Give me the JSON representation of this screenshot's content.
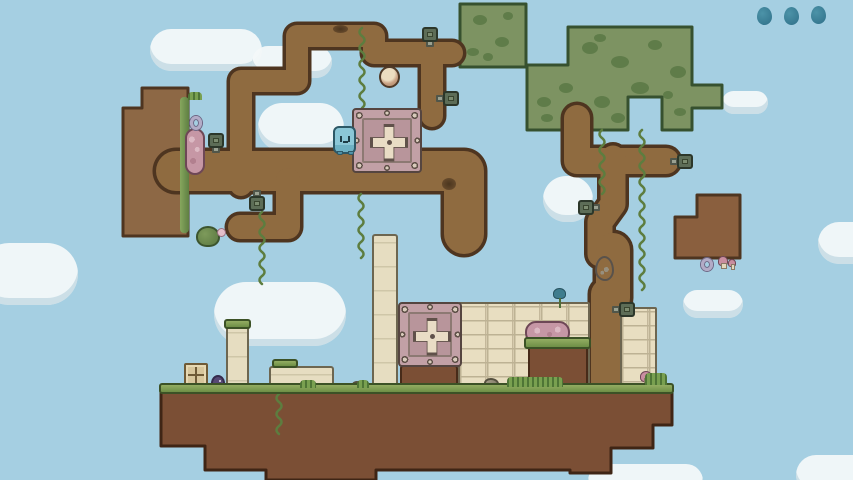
{
  "hud": {
    "menu_dots": {
      "count": 3,
      "color": "#3a7d93",
      "w": 15,
      "h": 18,
      "items": [
        {
          "x": 757,
          "y": 7
        },
        {
          "x": 784,
          "y": 7
        },
        {
          "x": 811,
          "y": 6
        }
      ]
    }
  },
  "palette": {
    "sky": "#a5cfe2",
    "path_fill": "#8f6b40",
    "path_outline": "#4e3520",
    "island_fill": "#7b4f35",
    "island_outline": "#3f2515",
    "hedge_fill": "#7d9362",
    "hedge_spot": "#5f7c49",
    "hedge_outline": "#36512f",
    "block_left_fill": "#8d6845",
    "block_right_fill": "#8a5f3e",
    "vine": "#5d7d3f",
    "stone": "#e8dec1",
    "crate_pink": "#c2a0a6",
    "character_blue": "#8bc7d7",
    "dot_teal": "#3a7d93"
  },
  "terrain": {
    "hedges": [
      {
        "name": "hedge-block-small",
        "d": "M460 4 H526 V67 H460 Z"
      },
      {
        "name": "hedge-block-large",
        "d": "M568 27 H692 V85 H722 V108 H692 V130 H662 V97 H628 V130 H527 V65 H568 Z"
      }
    ],
    "hedge_spots": [
      [
        480,
        20,
        7,
        5
      ],
      [
        502,
        42,
        7,
        5
      ],
      [
        473,
        52,
        6,
        4
      ],
      [
        508,
        16,
        5,
        4
      ],
      [
        488,
        57,
        5,
        4
      ],
      [
        590,
        48,
        8,
        6
      ],
      [
        620,
        62,
        9,
        6
      ],
      [
        655,
        45,
        7,
        5
      ],
      [
        678,
        72,
        8,
        6
      ],
      [
        640,
        88,
        9,
        6
      ],
      [
        602,
        102,
        8,
        6
      ],
      [
        566,
        88,
        7,
        5
      ],
      [
        544,
        102,
        7,
        5
      ],
      [
        680,
        112,
        6,
        4
      ],
      [
        618,
        118,
        7,
        5
      ],
      [
        584,
        120,
        6,
        4
      ],
      [
        547,
        118,
        6,
        4
      ],
      [
        600,
        38,
        6,
        4
      ],
      [
        668,
        95,
        5,
        4
      ]
    ],
    "blocks": [
      {
        "name": "dirt-block-left",
        "fill": "#8d6845",
        "d": "M142 88 H188 V236 H123 V108 H142 Z"
      },
      {
        "name": "dirt-block-right",
        "fill": "#8a5f3e",
        "d": "M697 195 H740 V258 H675 V217 H697 Z"
      }
    ],
    "routes": [
      {
        "name": "dirt-path-main",
        "d": "M 176 171 H 464 V 234",
        "w": 40
      },
      {
        "name": "dirt-path-hook",
        "d": "M 288 180 V 227 H 240",
        "w": 24
      },
      {
        "name": "dirt-path-stairs",
        "d": "M 241 185 V 81 H 297 V 36 H 374 V 53 H 452",
        "w": 22
      },
      {
        "name": "dirt-path-drop",
        "d": "M 432 60 V 116",
        "w": 22
      },
      {
        "name": "dirt-trunk-top",
        "d": "M 577 118 V 161 H 666",
        "w": 26
      },
      {
        "name": "dirt-trunk-mid",
        "d": "M 613 158 V 204 L 600 222 V 254",
        "w": 25
      },
      {
        "name": "dirt-trunk-egg",
        "d": "M 613 250 V 298",
        "w": 34
      },
      {
        "name": "dirt-trunk-low",
        "d": "M 606 294 V 392",
        "w": 30
      }
    ],
    "island": {
      "points": "161,392 672,392 672,425 653,425 653,448 611,448 611,473 570,473 570,470 376,470 376,480 266,480 266,470 205,470 205,446 161,446"
    },
    "vines": [
      {
        "x": 262,
        "y1": 212,
        "y2": 282
      },
      {
        "x": 361,
        "y1": 194,
        "y2": 258
      },
      {
        "x": 362,
        "y1": 28,
        "y2": 105
      },
      {
        "x": 279,
        "y1": 394,
        "y2": 434
      },
      {
        "x": 602,
        "y1": 130,
        "y2": 192
      },
      {
        "x": 642,
        "y1": 130,
        "y2": 283
      }
    ]
  },
  "clouds": [
    {
      "x": 150,
      "y": 29,
      "w": 112,
      "h": 42
    },
    {
      "x": 252,
      "y": 46,
      "w": 80,
      "h": 32
    },
    {
      "x": -22,
      "y": 243,
      "w": 100,
      "h": 62
    },
    {
      "x": 214,
      "y": 282,
      "w": 132,
      "h": 64
    },
    {
      "x": 258,
      "y": 103,
      "w": 86,
      "h": 48
    },
    {
      "x": 543,
      "y": 176,
      "w": 50,
      "h": 46
    },
    {
      "x": 683,
      "y": 290,
      "w": 60,
      "h": 28
    },
    {
      "x": 818,
      "y": 222,
      "w": 72,
      "h": 42
    },
    {
      "x": 722,
      "y": 91,
      "w": 46,
      "h": 23
    },
    {
      "x": 588,
      "y": 464,
      "w": 115,
      "h": 34
    },
    {
      "x": 796,
      "y": 455,
      "w": 90,
      "h": 40
    }
  ],
  "sprites": [
    {
      "t": "wall",
      "n": "stone-wall-main",
      "x": 458,
      "y": 302,
      "w": 132,
      "h": 88
    },
    {
      "t": "wall",
      "n": "stone-wall-right",
      "x": 620,
      "y": 307,
      "w": 37,
      "h": 81
    },
    {
      "t": "dirt",
      "n": "dirt-alcove",
      "x": 528,
      "y": 344,
      "w": 60,
      "h": 44
    },
    {
      "t": "dirt",
      "n": "crate-pedestal",
      "x": 400,
      "y": 365,
      "w": 58,
      "h": 23
    },
    {
      "t": "pillar",
      "n": "stone-pillar-tall",
      "x": 372,
      "y": 234,
      "w": 26,
      "h": 156
    },
    {
      "t": "pillar",
      "n": "stone-pillar-small",
      "x": 226,
      "y": 324,
      "w": 23,
      "h": 64
    },
    {
      "t": "pillar",
      "n": "stone-slab",
      "x": 269,
      "y": 366,
      "w": 65,
      "h": 22
    },
    {
      "t": "woodcrate",
      "n": "wooden-crate",
      "x": 184,
      "y": 363,
      "w": 24,
      "h": 24
    },
    {
      "t": "crate",
      "n": "metal-crate-upper",
      "x": 352,
      "y": 108,
      "w": 70,
      "h": 65
    },
    {
      "t": "crate",
      "n": "metal-crate-lower",
      "x": 398,
      "y": 302,
      "w": 64,
      "h": 65
    },
    {
      "t": "moss",
      "n": "moss-edge",
      "x": 180,
      "y": 97,
      "w": 9,
      "h": 136
    },
    {
      "t": "pinkpill",
      "n": "pink-mushroom-pill",
      "x": 185,
      "y": 128,
      "w": 20,
      "h": 47
    },
    {
      "t": "pinkslab",
      "n": "pink-mushroom-slab",
      "x": 525,
      "y": 321,
      "w": 45,
      "h": 23
    },
    {
      "t": "mushs",
      "n": "small-mushroom",
      "x": 718,
      "y": 256,
      "w": 10,
      "h": 10
    },
    {
      "t": "mushs",
      "n": "small-mushroom",
      "x": 728,
      "y": 259,
      "w": 8,
      "h": 8
    },
    {
      "t": "mushs",
      "n": "small-mushroom",
      "x": 640,
      "y": 371,
      "w": 12,
      "h": 11
    },
    {
      "t": "ring",
      "n": "ring-item",
      "x": 190,
      "y": 116,
      "w": 12,
      "h": 14
    },
    {
      "t": "ring",
      "n": "ring-item",
      "x": 701,
      "y": 258,
      "w": 12,
      "h": 13
    },
    {
      "t": "flower",
      "n": "blue-flower",
      "x": 553,
      "y": 288,
      "w": 13,
      "h": 11
    },
    {
      "t": "rock",
      "n": "rock",
      "x": 484,
      "y": 378,
      "w": 15,
      "h": 11
    },
    {
      "t": "rock",
      "n": "rock",
      "x": 352,
      "y": 381,
      "w": 11,
      "h": 8
    },
    {
      "t": "bush",
      "n": "bush",
      "x": 196,
      "y": 226,
      "w": 24,
      "h": 21
    },
    {
      "t": "flowerdot",
      "n": "flower-dot",
      "x": 217,
      "y": 228,
      "w": 9,
      "h": 9
    },
    {
      "t": "critter",
      "n": "purple-critter",
      "x": 211,
      "y": 375,
      "w": 14,
      "h": 13
    },
    {
      "t": "hole",
      "n": "dirt-hole",
      "x": 333,
      "y": 25,
      "w": 15,
      "h": 8
    },
    {
      "t": "hole",
      "n": "dirt-hole",
      "x": 442,
      "y": 178,
      "w": 14,
      "h": 12
    },
    {
      "t": "egg",
      "n": "egg-item",
      "x": 595,
      "y": 256,
      "w": 19,
      "h": 25
    },
    {
      "t": "mushball",
      "n": "mushroom-ball",
      "x": 379,
      "y": 66,
      "w": 21,
      "h": 22
    }
  ],
  "bolts": [
    {
      "x": 208,
      "y": 133,
      "dir": "down"
    },
    {
      "x": 249,
      "y": 196,
      "dir": "up"
    },
    {
      "x": 422,
      "y": 27,
      "dir": "down"
    },
    {
      "x": 443,
      "y": 91,
      "dir": "left"
    },
    {
      "x": 677,
      "y": 154,
      "dir": "left"
    },
    {
      "x": 578,
      "y": 200,
      "dir": "right"
    },
    {
      "x": 619,
      "y": 302,
      "dir": "left"
    }
  ],
  "grass": {
    "strip": {
      "x": 159,
      "y": 383,
      "w": 515,
      "h": 11
    },
    "caps": [
      {
        "x": 224,
        "y": 319,
        "w": 27,
        "h": 10
      },
      {
        "x": 272,
        "y": 359,
        "w": 26,
        "h": 9
      },
      {
        "x": 524,
        "y": 337,
        "w": 67,
        "h": 12
      }
    ],
    "tufts": [
      {
        "x": 300,
        "y": 380,
        "w": 16,
        "h": 8
      },
      {
        "x": 357,
        "y": 380,
        "w": 12,
        "h": 8
      },
      {
        "x": 507,
        "y": 377,
        "w": 56,
        "h": 10
      },
      {
        "x": 645,
        "y": 373,
        "w": 22,
        "h": 12
      },
      {
        "x": 188,
        "y": 92,
        "w": 14,
        "h": 8
      }
    ]
  },
  "character": {
    "x": 333,
    "y": 126,
    "w": 23,
    "h": 28
  }
}
